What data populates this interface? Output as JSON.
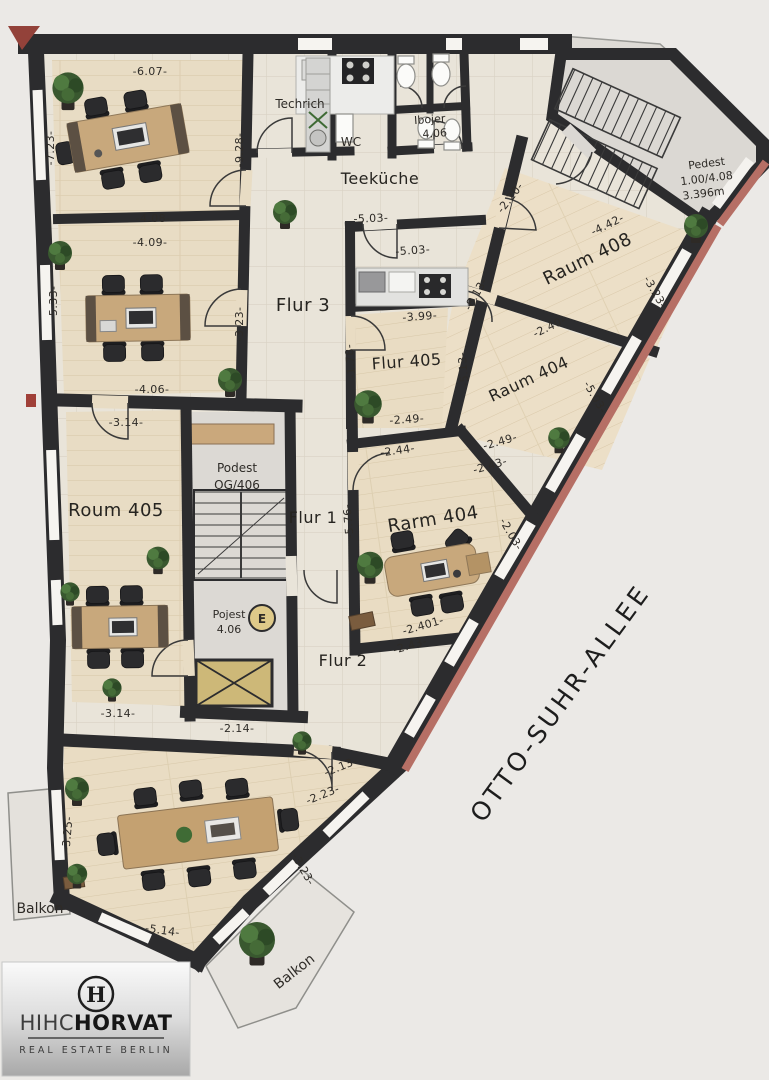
{
  "street": {
    "label": "OTTO-SUHR-ALLEE"
  },
  "rooms": {
    "technik": "Techrich",
    "wc": "WC",
    "teekueche": "Teeküche",
    "flur3": "Flur 3",
    "flur405": "Flur 405",
    "raum408": "Raum 408",
    "raum404_upper": "Raum 404",
    "raum404_lower": "Rarm 404",
    "raum405": "Roum 405",
    "flur1": "Flur 1",
    "flur2": "Flur 2"
  },
  "foyer": {
    "line1": "Ibojer",
    "line2": "4.06"
  },
  "stair_note": {
    "line1": "Pedest",
    "line2": "1.00/4.08",
    "line3": "3.396m"
  },
  "podest": {
    "line1": "Podest",
    "line2": "OG/406"
  },
  "pojest": {
    "line1": "Pojest",
    "line2": "4.06"
  },
  "elevator": {
    "label": "E"
  },
  "balconies": {
    "left": "Balkon",
    "bottom": "Balkon"
  },
  "dimensions": {
    "d607": "-6.07-",
    "d723": "-7.23-",
    "d928": "-9.28-",
    "d408": "-4.08-",
    "d409": "-4.09-",
    "d533": "-5.33-",
    "d323a": "-3.23-",
    "d406": "-4.06-",
    "d314a": "-3.14-",
    "d503a": "-5.03-",
    "d503b": "-5.03-",
    "d399": "-3.99-",
    "d178": "-1.78-",
    "d249a": "-2.49-",
    "d220": "-2.20-",
    "d442": "-4.42-",
    "d323b": "-3.23-",
    "d240": "-2.40-",
    "d513": "-5.13-",
    "d813": "-8.13-",
    "d503c": "-5.03-",
    "d249b": "-2.49-",
    "d243a": "-2.43-",
    "d244": "-2.44-",
    "d576": "-5.76-",
    "d203": "-2.03-",
    "d2401": "-2.401-",
    "d243b": "-2.43-",
    "d314b": "-3.14-",
    "d214": "-2.14-",
    "d213": "-2.13-",
    "d223": "-2.23-",
    "d323c": "-3.23-",
    "d325": "-3.25-",
    "d514": "-5.14-"
  },
  "logo": {
    "monogram": "H",
    "brand_light": "HIHC",
    "brand_bold": "HORVAT",
    "tagline": "REAL ESTATE BERLIN"
  },
  "colors": {
    "wall": "#2c2c2e",
    "facade_accent": "#b66f65",
    "corner_accent": "#93423a",
    "elevator_fill": "#cdb878",
    "wood": "#e8dcc4",
    "tile": "#e9e4d9",
    "paper": "#ebe9e6"
  }
}
